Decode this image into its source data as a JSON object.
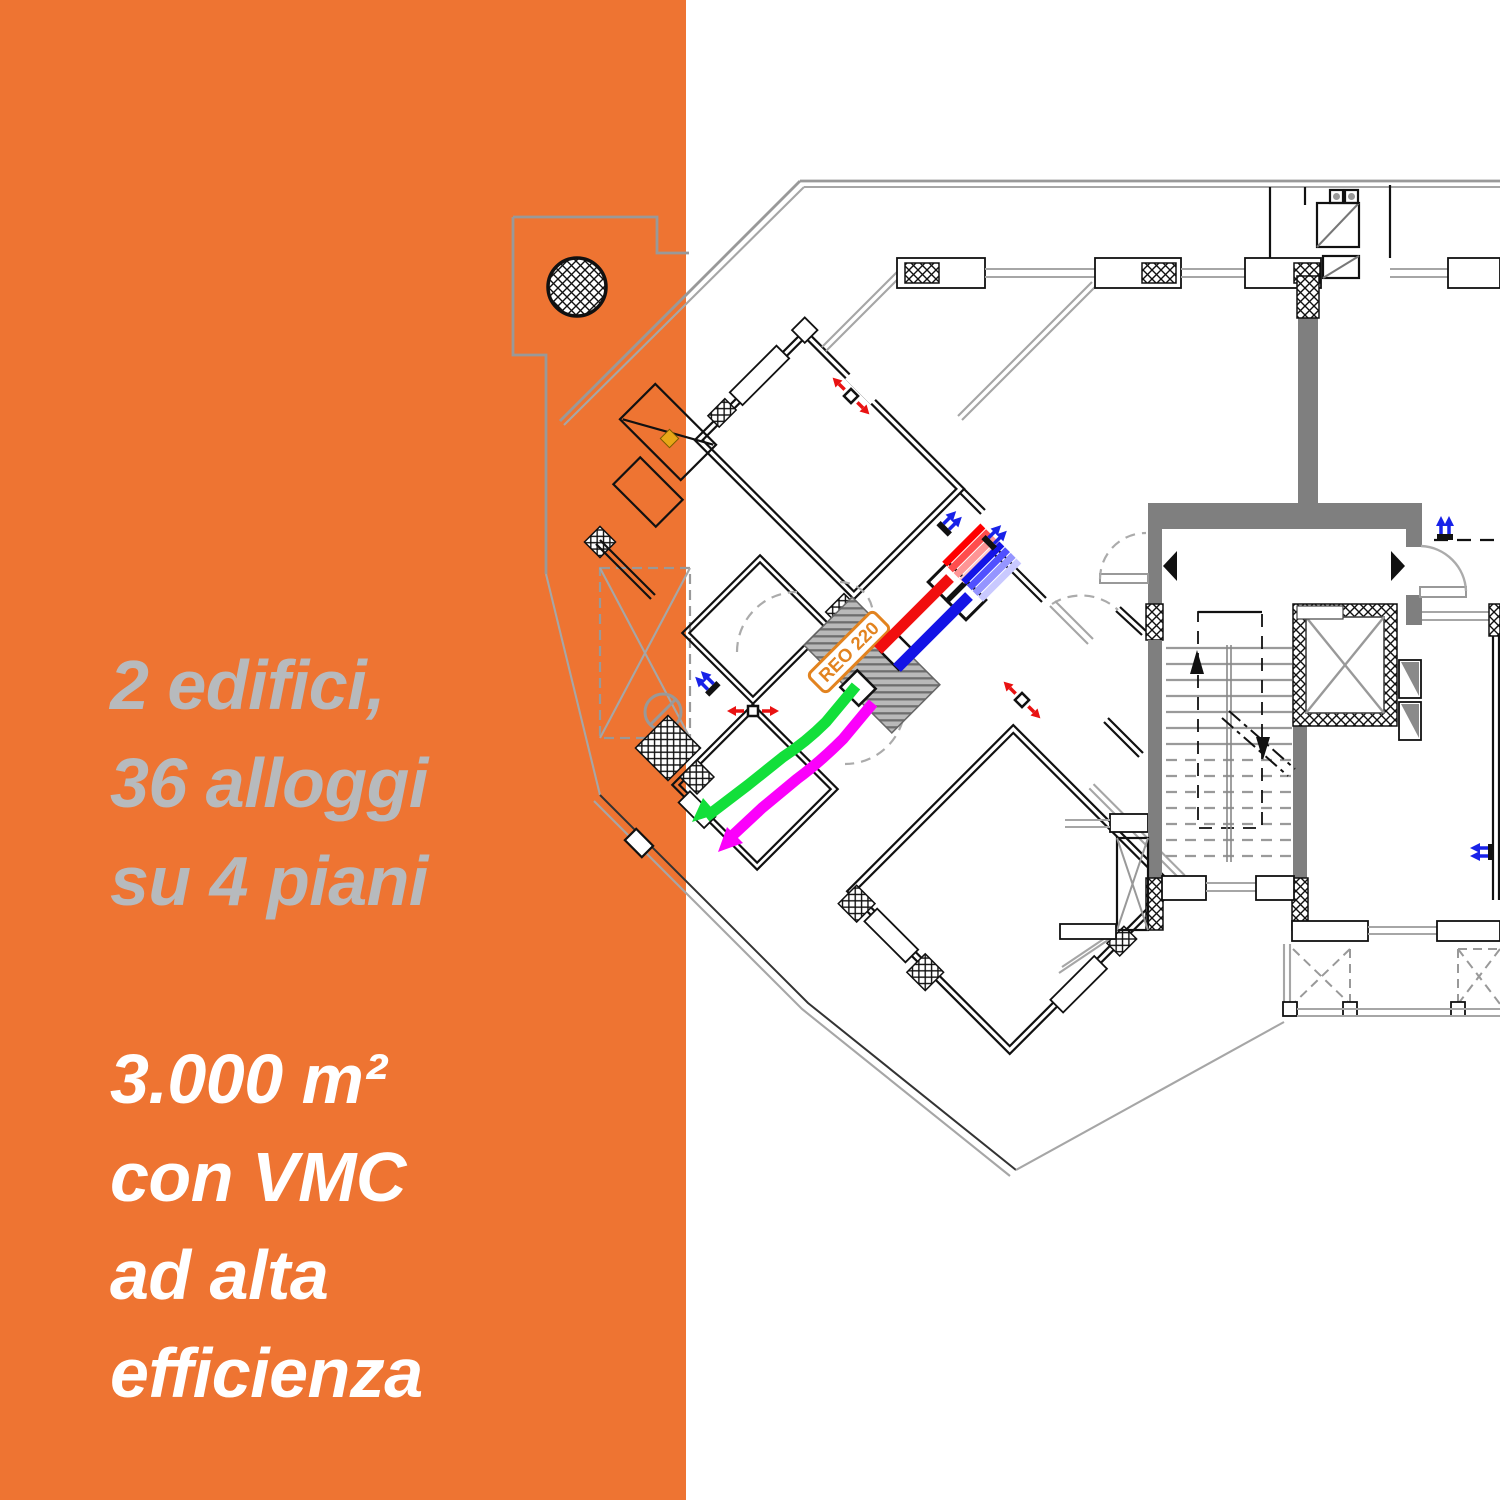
{
  "panel": {
    "bg_color": "#EE7432",
    "stat_block_1": {
      "color": "#B7BABD",
      "lines": [
        "2 edifici,",
        "36 alloggi",
        "su 4 piani"
      ]
    },
    "stat_block_2": {
      "color": "#FFFFFF",
      "lines": [
        "3.000 m²",
        "con VMC",
        "ad alta",
        "efficienza"
      ]
    }
  },
  "floorplan": {
    "vmc_unit_label": "REO 220",
    "legend_colors": {
      "supply_duct_red": "#F10E0E",
      "return_duct_blue": "#1414E6",
      "fresh_air_duct_green": "#12DF3A",
      "exhaust_duct_magenta": "#FB00FB",
      "structural_wall_gray": "#7F7F7F",
      "boundary_line_gray": "#999999",
      "unit_label_orange": "#E2831F"
    }
  }
}
